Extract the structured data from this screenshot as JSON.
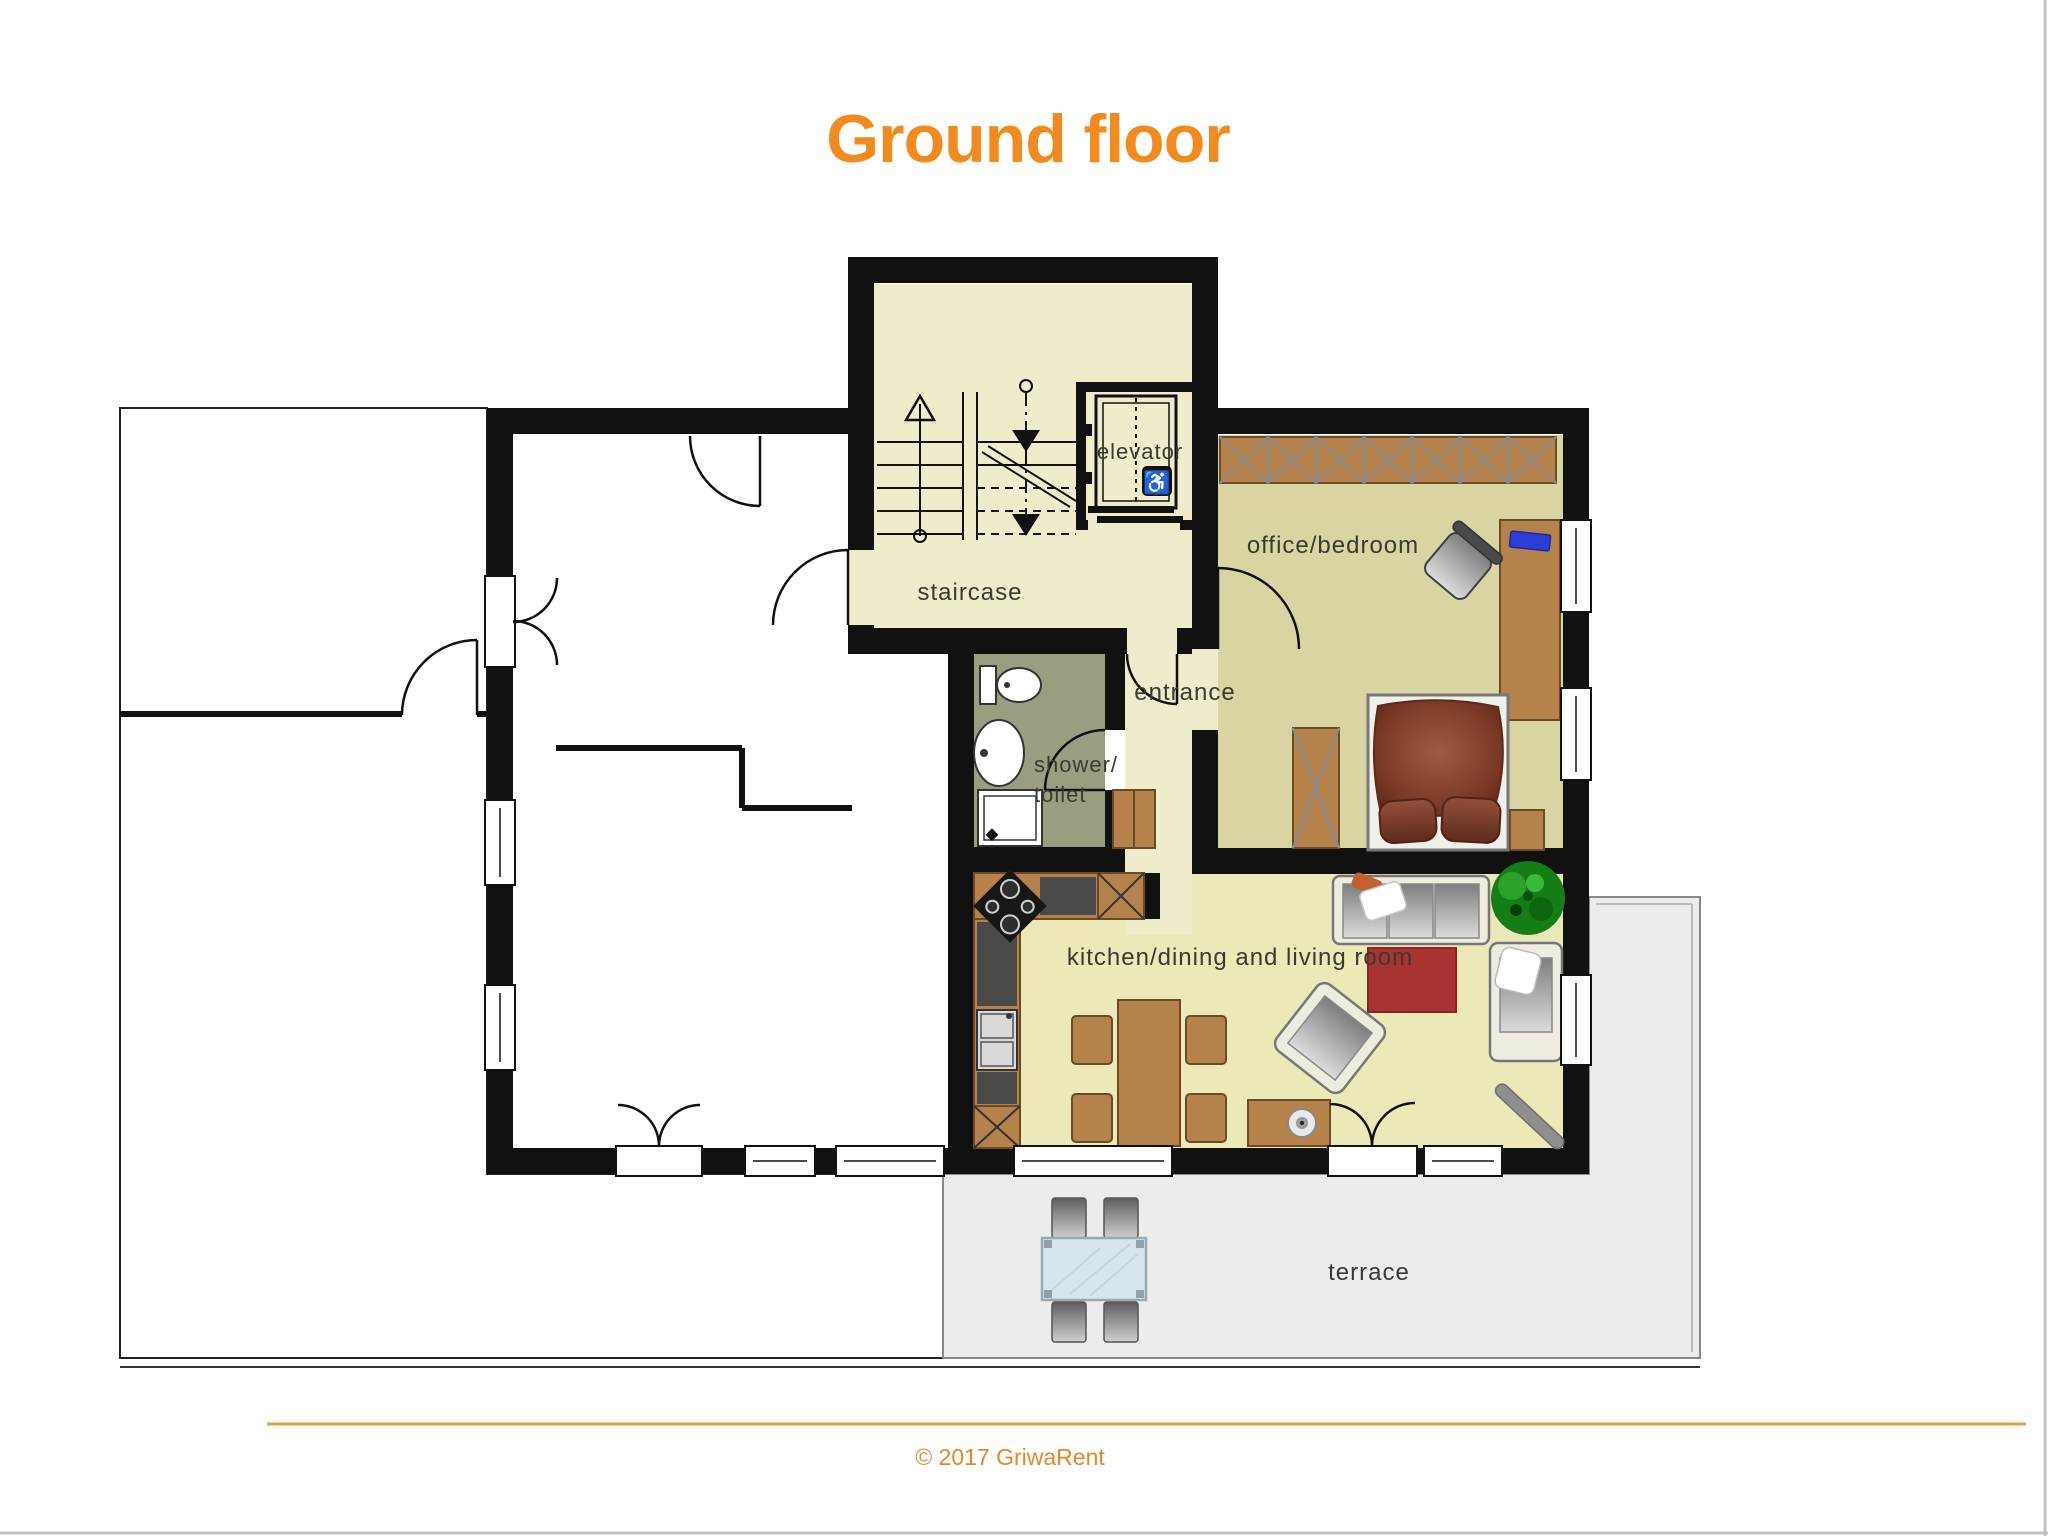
{
  "title": {
    "text": "Ground floor"
  },
  "rooms": {
    "staircase": "staircase",
    "office_bedroom": "office/bedroom",
    "entrance": "entrance",
    "shower_line1": "shower/",
    "shower_line2": "toilet",
    "kitchen_living": "kitchen/dining and living room",
    "terrace": "terrace"
  },
  "elevator": {
    "label": "elevator",
    "wheelchair_icon": "♿"
  },
  "footer": {
    "copyright": "© 2017 GriwaRent"
  },
  "colors": {
    "accent_orange": "#f28a1e",
    "wall": "#111111",
    "stair_room": "#eeeccb",
    "bedroom": "#d8d5a2",
    "living": "#ebe9b8",
    "bathroom": "#9c9c80",
    "terrace": "#ececec",
    "wood": "#b5824c",
    "footer_line": "#dfa24a",
    "footer_text": "#e1892a"
  }
}
